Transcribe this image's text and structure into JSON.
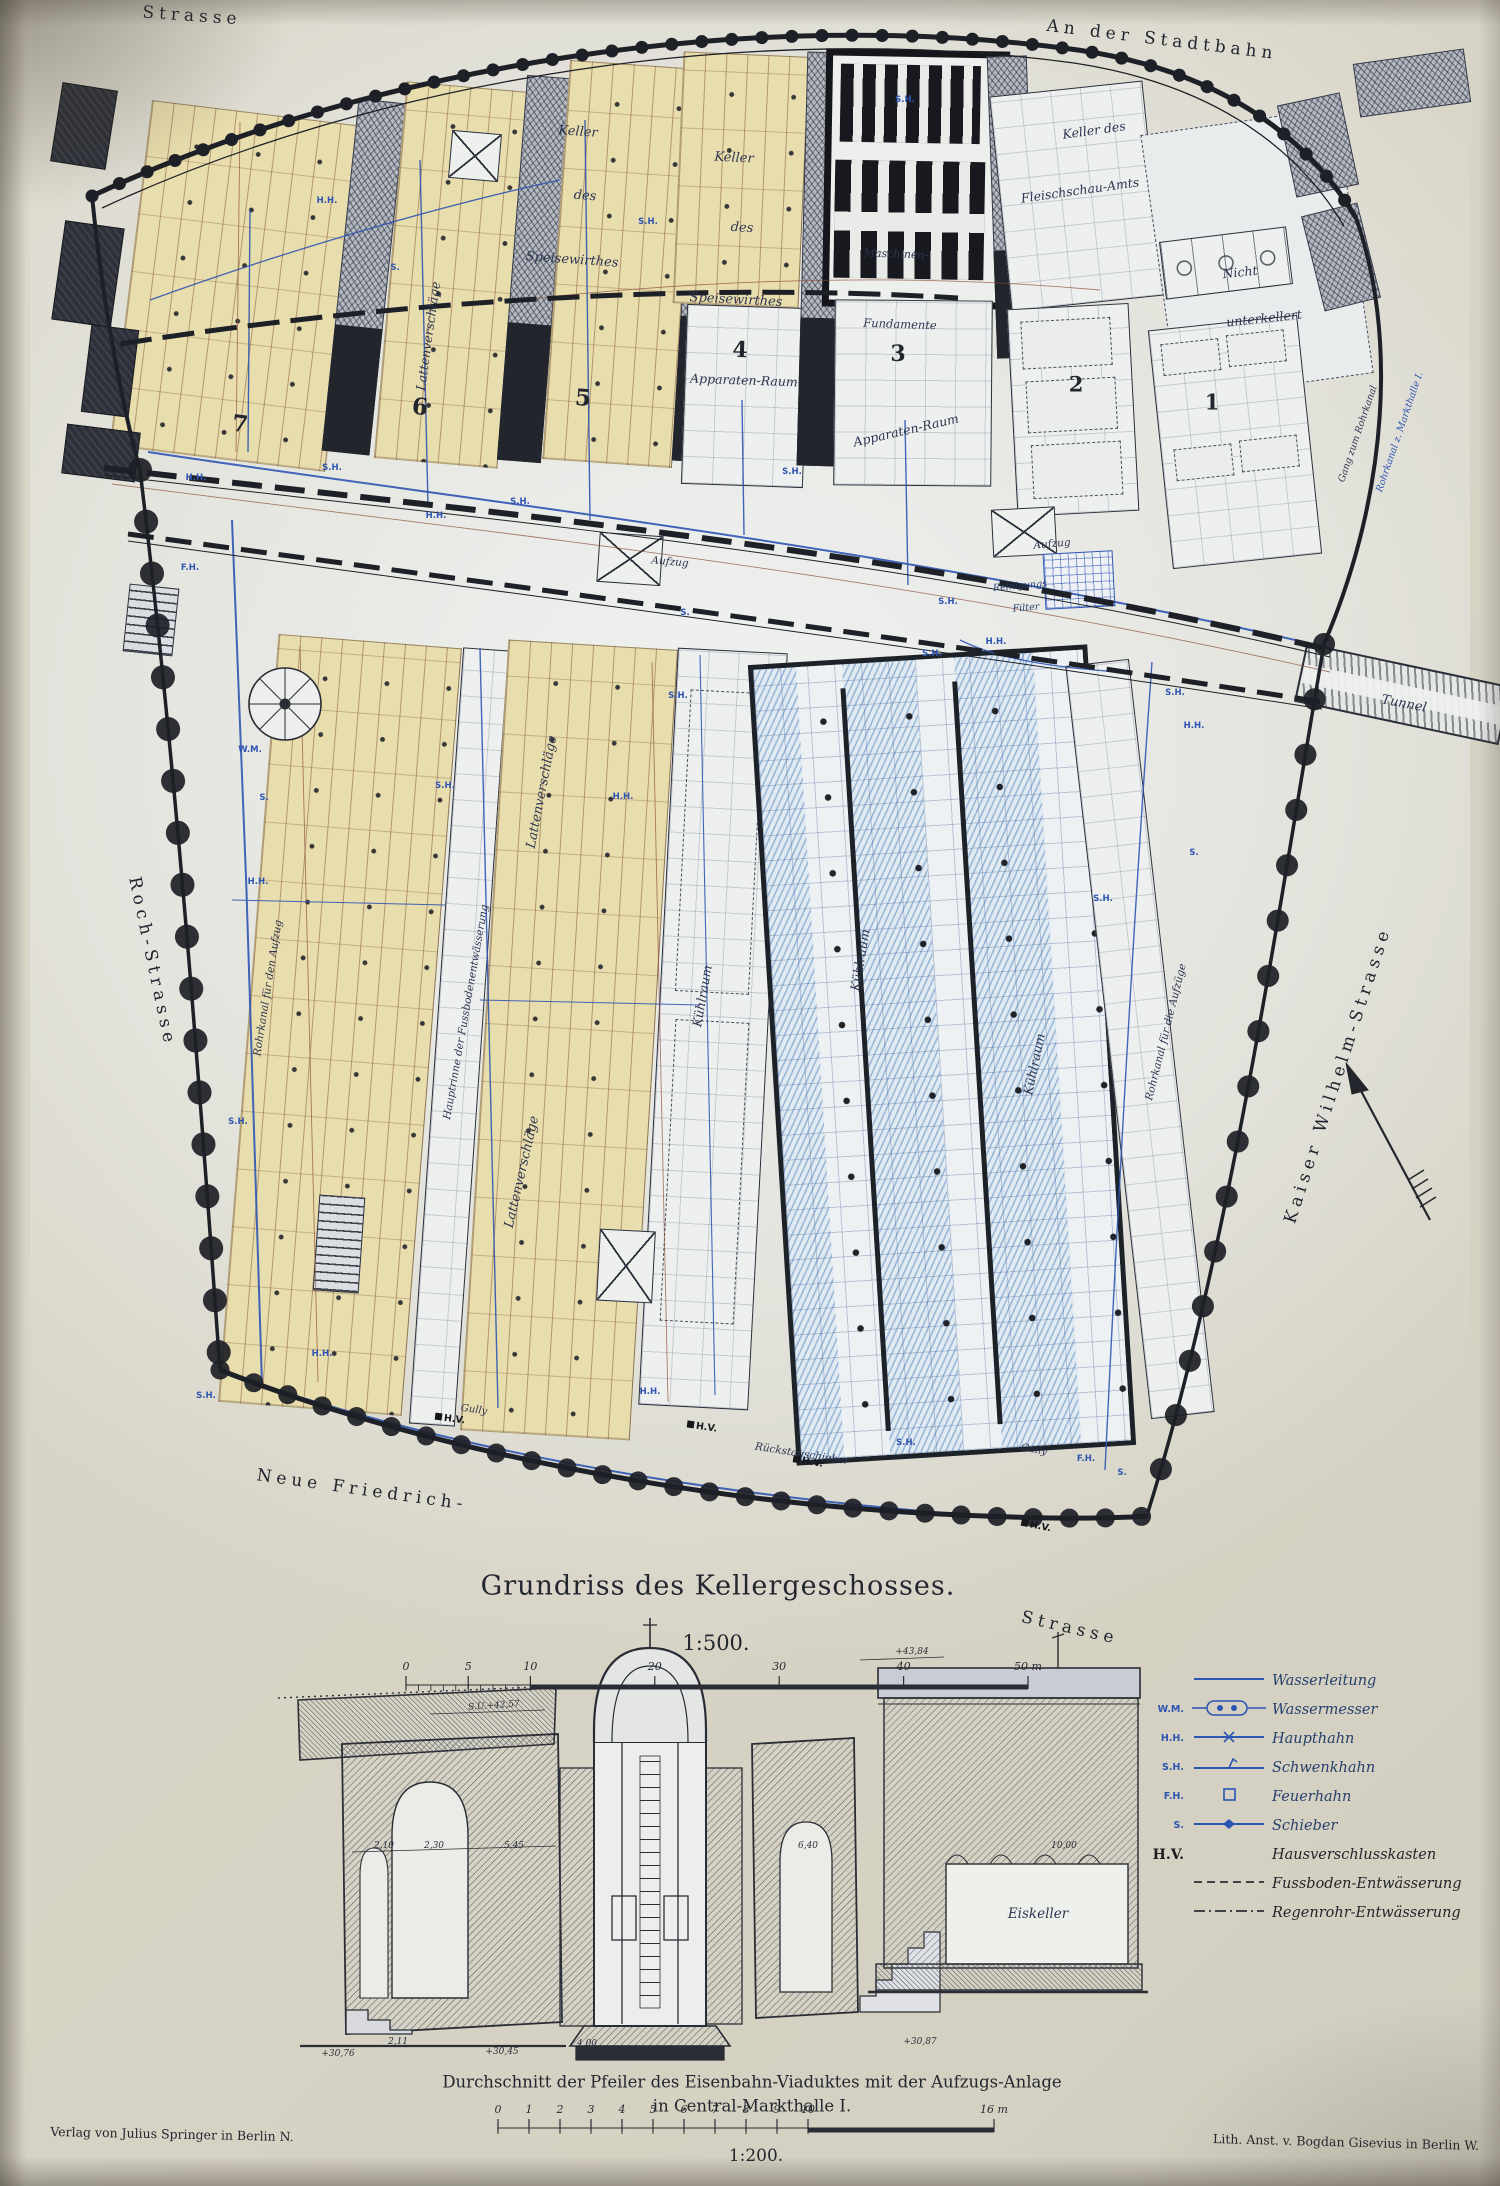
{
  "page": {
    "title": "Grundriss des Kellergeschosses.",
    "plan_scale": "1:500.",
    "section_title_1": "Durchschnitt der Pfeiler des Eisenbahn-Viaduktes mit der Aufzugs-Anlage",
    "section_title_2": "in Central-Markthalle I.",
    "section_scale": "1:200.",
    "publisher_left": "Verlag von Julius Springer in Berlin N.",
    "publisher_right": "Lith. Anst. v. Bogdan Gisevius in Berlin W."
  },
  "plan": {
    "labels": [
      {
        "n": "street-strasse-top",
        "t": "Strasse",
        "x": 192,
        "y": 16,
        "r": 4,
        "s": 17,
        "c": "street"
      },
      {
        "n": "street-an-der-stadtbahn",
        "t": "An der Stadtbahn",
        "x": 1162,
        "y": 40,
        "r": 7,
        "s": 17,
        "c": "street"
      },
      {
        "n": "street-roch-strasse",
        "t": "Roch-Strasse",
        "x": 152,
        "y": 962,
        "r": 78,
        "s": 17,
        "c": "street"
      },
      {
        "n": "street-kaiser-wilhelm",
        "t": "Kaiser Wilhelm-Strasse",
        "x": 1338,
        "y": 1075,
        "r": -72,
        "s": 17,
        "c": "street"
      },
      {
        "n": "street-neue-friedrich",
        "t": "Neue Friedrich-",
        "x": 362,
        "y": 1490,
        "r": 8,
        "s": 17,
        "c": "street"
      },
      {
        "n": "street-strasse-bottom",
        "t": "Strasse",
        "x": 1070,
        "y": 1628,
        "r": 13,
        "s": 17,
        "c": "street"
      },
      {
        "n": "label-keller-1",
        "t": "Keller",
        "x": 578,
        "y": 132,
        "r": 4,
        "s": 13,
        "c": "it"
      },
      {
        "n": "label-des-1",
        "t": "des",
        "x": 585,
        "y": 196,
        "r": 4,
        "s": 13,
        "c": "it"
      },
      {
        "n": "label-speisewirthes-1",
        "t": "Speisewirthes",
        "x": 572,
        "y": 260,
        "r": 4,
        "s": 13,
        "c": "it"
      },
      {
        "n": "label-keller-2",
        "t": "Keller",
        "x": 734,
        "y": 158,
        "r": 3,
        "s": 13,
        "c": "it"
      },
      {
        "n": "label-des-2",
        "t": "des",
        "x": 742,
        "y": 228,
        "r": 3,
        "s": 13,
        "c": "it"
      },
      {
        "n": "label-speisewirthes-2",
        "t": "Speisewirthes",
        "x": 736,
        "y": 300,
        "r": 3,
        "s": 13,
        "c": "it"
      },
      {
        "n": "label-lattenverschlaege-a",
        "t": "Lattenverschläge",
        "x": 428,
        "y": 336,
        "r": -82,
        "s": 12.5,
        "c": "it"
      },
      {
        "n": "room-number-7",
        "t": "7",
        "x": 240,
        "y": 424,
        "r": 7,
        "s": 23,
        "c": "num"
      },
      {
        "n": "room-number-6",
        "t": "6",
        "x": 420,
        "y": 407,
        "r": 5,
        "s": 23,
        "c": "num"
      },
      {
        "n": "room-number-5",
        "t": "5",
        "x": 583,
        "y": 398,
        "r": 4,
        "s": 23,
        "c": "num"
      },
      {
        "n": "room-number-4",
        "t": "4",
        "x": 740,
        "y": 350,
        "r": 2,
        "s": 22,
        "c": "num"
      },
      {
        "n": "label-apparaten-raum-4",
        "t": "Apparaten-Raum",
        "x": 744,
        "y": 380,
        "r": 2,
        "s": 12.5,
        "c": "it"
      },
      {
        "n": "room-number-3",
        "t": "3",
        "x": 898,
        "y": 354,
        "r": 0,
        "s": 22,
        "c": "num"
      },
      {
        "n": "label-apparaten-raum-3",
        "t": "Apparaten-Raum",
        "x": 906,
        "y": 430,
        "r": -13,
        "s": 12.5,
        "c": "it"
      },
      {
        "n": "room-number-2",
        "t": "2",
        "x": 1076,
        "y": 384,
        "r": 0,
        "s": 21,
        "c": "num"
      },
      {
        "n": "room-number-1",
        "t": "1",
        "x": 1212,
        "y": 402,
        "r": 0,
        "s": 21,
        "c": "num"
      },
      {
        "n": "label-maschinen",
        "t": "Maschinen-",
        "x": 896,
        "y": 254,
        "r": 2,
        "s": 11,
        "c": "it"
      },
      {
        "n": "label-fundamente",
        "t": "Fundamente",
        "x": 900,
        "y": 324,
        "r": 2,
        "s": 11.5,
        "c": "it"
      },
      {
        "n": "label-keller-des",
        "t": "Keller des",
        "x": 1094,
        "y": 130,
        "r": -8,
        "s": 12.5,
        "c": "it"
      },
      {
        "n": "label-fleischschau-amts",
        "t": "Fleischschau-Amts",
        "x": 1080,
        "y": 190,
        "r": -8,
        "s": 12.5,
        "c": "it"
      },
      {
        "n": "label-nicht",
        "t": "Nicht",
        "x": 1240,
        "y": 272,
        "r": -6,
        "s": 12.5,
        "c": "it"
      },
      {
        "n": "label-unterkellert",
        "t": "unterkellert",
        "x": 1264,
        "y": 318,
        "r": -6,
        "s": 12.5,
        "c": "it"
      },
      {
        "n": "label-aufzug-1",
        "t": "Aufzug",
        "x": 670,
        "y": 562,
        "r": 5,
        "s": 10.5,
        "c": "it"
      },
      {
        "n": "label-aufzug-2",
        "t": "Aufzug",
        "x": 1052,
        "y": 544,
        "r": -5,
        "s": 10.5,
        "c": "it"
      },
      {
        "n": "label-reinigungs",
        "t": "Reinigungs",
        "x": 1020,
        "y": 586,
        "r": -5,
        "s": 9.5,
        "c": "it dkb"
      },
      {
        "n": "label-filter",
        "t": "Filter",
        "x": 1026,
        "y": 608,
        "r": -5,
        "s": 9.5,
        "c": "it dkb"
      },
      {
        "n": "label-gang-zum-rohrkanal",
        "t": "Gang zum Rohrkanal",
        "x": 1358,
        "y": 434,
        "r": -71,
        "s": 9.5,
        "c": "it"
      },
      {
        "n": "label-rohrkanal-markthalle",
        "t": "Rohrkanal z. Markthalle I.",
        "x": 1400,
        "y": 432,
        "r": -71,
        "s": 9.5,
        "c": "it blu"
      },
      {
        "n": "label-tunnel",
        "t": "Tunnel",
        "x": 1404,
        "y": 704,
        "r": 11,
        "s": 13,
        "c": "it"
      },
      {
        "n": "label-rohrkanal-aufzug",
        "t": "Rohrkanal für den Aufzug",
        "x": 268,
        "y": 988,
        "r": -81,
        "s": 10.5,
        "c": "it"
      },
      {
        "n": "label-hauptrinne",
        "t": "Hauptrinne der Fussbodenentwässerung",
        "x": 466,
        "y": 1012,
        "r": -80,
        "s": 10.5,
        "c": "it"
      },
      {
        "n": "label-lattenverschlaege-b",
        "t": "Lattenverschläge",
        "x": 542,
        "y": 792,
        "r": -79,
        "s": 13,
        "c": "it"
      },
      {
        "n": "label-lattenverschlaege-c",
        "t": "Lattenverschläge",
        "x": 522,
        "y": 1172,
        "r": -77,
        "s": 13,
        "c": "it"
      },
      {
        "n": "label-kuehlraum-1",
        "t": "Kühlraum",
        "x": 702,
        "y": 996,
        "r": -80,
        "s": 12.5,
        "c": "it"
      },
      {
        "n": "label-kuehlraum-2",
        "t": "Kühlraum",
        "x": 860,
        "y": 960,
        "r": -80,
        "s": 12.5,
        "c": "it"
      },
      {
        "n": "label-kuehlraum-3",
        "t": "Kühlraum",
        "x": 1034,
        "y": 1064,
        "r": -78,
        "s": 12.5,
        "c": "it"
      },
      {
        "n": "label-rohrkanal-aufzuege",
        "t": "Rohrkanal für die Aufzüge",
        "x": 1166,
        "y": 1032,
        "r": -76,
        "s": 10.5,
        "c": "it"
      },
      {
        "n": "label-rueckstauschieber",
        "t": "Rückstauschieber",
        "x": 802,
        "y": 1454,
        "r": 9,
        "s": 10.5,
        "c": "it"
      },
      {
        "n": "label-gully-1",
        "t": "Gully",
        "x": 474,
        "y": 1410,
        "r": 8,
        "s": 10,
        "c": "it"
      },
      {
        "n": "label-gully-2",
        "t": "Gully",
        "x": 1034,
        "y": 1450,
        "r": 10,
        "s": 10,
        "c": "it"
      },
      {
        "n": "marker-hv-1",
        "t": "H.V.",
        "x": 702,
        "y": 1427,
        "r": 8,
        "s": 9.5,
        "c": "hv"
      },
      {
        "n": "marker-hv-2",
        "t": "H.V.",
        "x": 808,
        "y": 1462,
        "r": 9,
        "s": 9.5,
        "c": "hv"
      },
      {
        "n": "marker-hv-3",
        "t": "H.V.",
        "x": 1036,
        "y": 1526,
        "r": 11,
        "s": 9.5,
        "c": "hv"
      },
      {
        "n": "marker-hv-4",
        "t": "H.V.",
        "x": 450,
        "y": 1419,
        "r": 7,
        "s": 9.5,
        "c": "hv"
      },
      {
        "n": "label-eiskeller",
        "t": "Eiskeller",
        "x": 1038,
        "y": 1914,
        "r": 0,
        "s": 13.5,
        "c": "it"
      },
      {
        "n": "elevation-43-84",
        "t": "+43,84",
        "x": 912,
        "y": 1652,
        "r": 0,
        "s": 9,
        "c": "dim"
      },
      {
        "n": "elevation-su-42-57",
        "t": "S.U.+42,57",
        "x": 494,
        "y": 1706,
        "r": -4,
        "s": 9,
        "c": "dim"
      },
      {
        "n": "dim-2-10",
        "t": "2,10",
        "x": 384,
        "y": 1846,
        "r": 0,
        "s": 9,
        "c": "dim"
      },
      {
        "n": "dim-2-30",
        "t": "2,30",
        "x": 434,
        "y": 1846,
        "r": 0,
        "s": 9,
        "c": "dim"
      },
      {
        "n": "dim-5-45",
        "t": "5,45",
        "x": 514,
        "y": 1846,
        "r": 0,
        "s": 9,
        "c": "dim"
      },
      {
        "n": "dim-6-40",
        "t": "6,40",
        "x": 808,
        "y": 1846,
        "r": 0,
        "s": 9,
        "c": "dim"
      },
      {
        "n": "dim-10-00",
        "t": "10,00",
        "x": 1064,
        "y": 1846,
        "r": 0,
        "s": 9,
        "c": "dim"
      },
      {
        "n": "elevation-30-76",
        "t": "+30,76",
        "x": 338,
        "y": 2054,
        "r": 0,
        "s": 9,
        "c": "dim"
      },
      {
        "n": "elevation-30-45",
        "t": "+30,45",
        "x": 502,
        "y": 2052,
        "r": 0,
        "s": 9,
        "c": "dim"
      },
      {
        "n": "elevation-30-87",
        "t": "+30,87",
        "x": 920,
        "y": 2042,
        "r": 0,
        "s": 9,
        "c": "dim"
      },
      {
        "n": "dim-4-00",
        "t": "4,00",
        "x": 587,
        "y": 2044,
        "r": 0,
        "s": 9,
        "c": "dim"
      },
      {
        "n": "dim-2-11",
        "t": "2,11",
        "x": 398,
        "y": 2042,
        "r": 0,
        "s": 9,
        "c": "dim"
      }
    ],
    "markers": [
      {
        "t": "H.H.",
        "x": 327,
        "y": 201
      },
      {
        "t": "S.",
        "x": 395,
        "y": 268
      },
      {
        "t": "S.H.",
        "x": 648,
        "y": 222
      },
      {
        "t": "S.H.",
        "x": 905,
        "y": 100
      },
      {
        "t": "S.H.",
        "x": 332,
        "y": 468
      },
      {
        "t": "H.H.",
        "x": 196,
        "y": 478
      },
      {
        "t": "S.H.",
        "x": 520,
        "y": 502
      },
      {
        "t": "H.H.",
        "x": 436,
        "y": 516
      },
      {
        "t": "S.H.",
        "x": 792,
        "y": 472
      },
      {
        "t": "S.H.",
        "x": 948,
        "y": 602
      },
      {
        "t": "H.H.",
        "x": 996,
        "y": 642
      },
      {
        "t": "F.H.",
        "x": 190,
        "y": 568
      },
      {
        "t": "W.M.",
        "x": 250,
        "y": 750
      },
      {
        "t": "S.",
        "x": 264,
        "y": 798
      },
      {
        "t": "H.H.",
        "x": 258,
        "y": 882
      },
      {
        "t": "S.H.",
        "x": 238,
        "y": 1122
      },
      {
        "t": "H.H.",
        "x": 322,
        "y": 1354
      },
      {
        "t": "S.H.",
        "x": 206,
        "y": 1396
      },
      {
        "t": "S.H.",
        "x": 445,
        "y": 786
      },
      {
        "t": "H.H.",
        "x": 623,
        "y": 797
      },
      {
        "t": "S.",
        "x": 685,
        "y": 613
      },
      {
        "t": "S.H.",
        "x": 678,
        "y": 696
      },
      {
        "t": "S.H.",
        "x": 932,
        "y": 654
      },
      {
        "t": "S.H.",
        "x": 1175,
        "y": 693
      },
      {
        "t": "H.H.",
        "x": 1194,
        "y": 726
      },
      {
        "t": "S.H.",
        "x": 1103,
        "y": 899
      },
      {
        "t": "S.",
        "x": 1194,
        "y": 853
      },
      {
        "t": "H.H.",
        "x": 650,
        "y": 1392
      },
      {
        "t": "S.H.",
        "x": 906,
        "y": 1443
      },
      {
        "t": "F.H.",
        "x": 1086,
        "y": 1459
      },
      {
        "t": "S.",
        "x": 1122,
        "y": 1473
      }
    ]
  },
  "legend": {
    "items": [
      {
        "abbr": "",
        "sym": "line",
        "label": "Wasserleitung",
        "black": false
      },
      {
        "abbr": "W.M.",
        "sym": "meter",
        "label": "Wassermesser",
        "black": false
      },
      {
        "abbr": "H.H.",
        "sym": "valvex",
        "label": "Haupthahn",
        "black": false
      },
      {
        "abbr": "S.H.",
        "sym": "flag",
        "label": "Schwenkhahn",
        "black": false
      },
      {
        "abbr": "F.H.",
        "sym": "sq",
        "label": "Feuerhahn",
        "black": false
      },
      {
        "abbr": "S.",
        "sym": "diamond",
        "label": "Schieber",
        "black": false
      },
      {
        "abbr": "H.V.",
        "sym": "none",
        "label": "Hausverschlusskasten",
        "black": true
      },
      {
        "abbr": "",
        "sym": "dash",
        "label": "Fussboden-Entwässerung",
        "black": true
      },
      {
        "abbr": "",
        "sym": "dashdot",
        "label": "Regenrohr-Entwässerung",
        "black": true
      }
    ]
  },
  "scalebar_plan": {
    "values": [
      0,
      5,
      10,
      20,
      30,
      40,
      50
    ],
    "unit_labels": [
      "0",
      "5",
      "10",
      "20",
      "30",
      "40",
      "50 m"
    ]
  },
  "scalebar_section": {
    "values": [
      0,
      1,
      2,
      3,
      4,
      5,
      6,
      7,
      8,
      9,
      10,
      16
    ],
    "unit_labels": [
      "0",
      "1",
      "2",
      "3",
      "4",
      "5",
      "6",
      "7",
      "8",
      "9",
      "10",
      "16 m"
    ]
  }
}
